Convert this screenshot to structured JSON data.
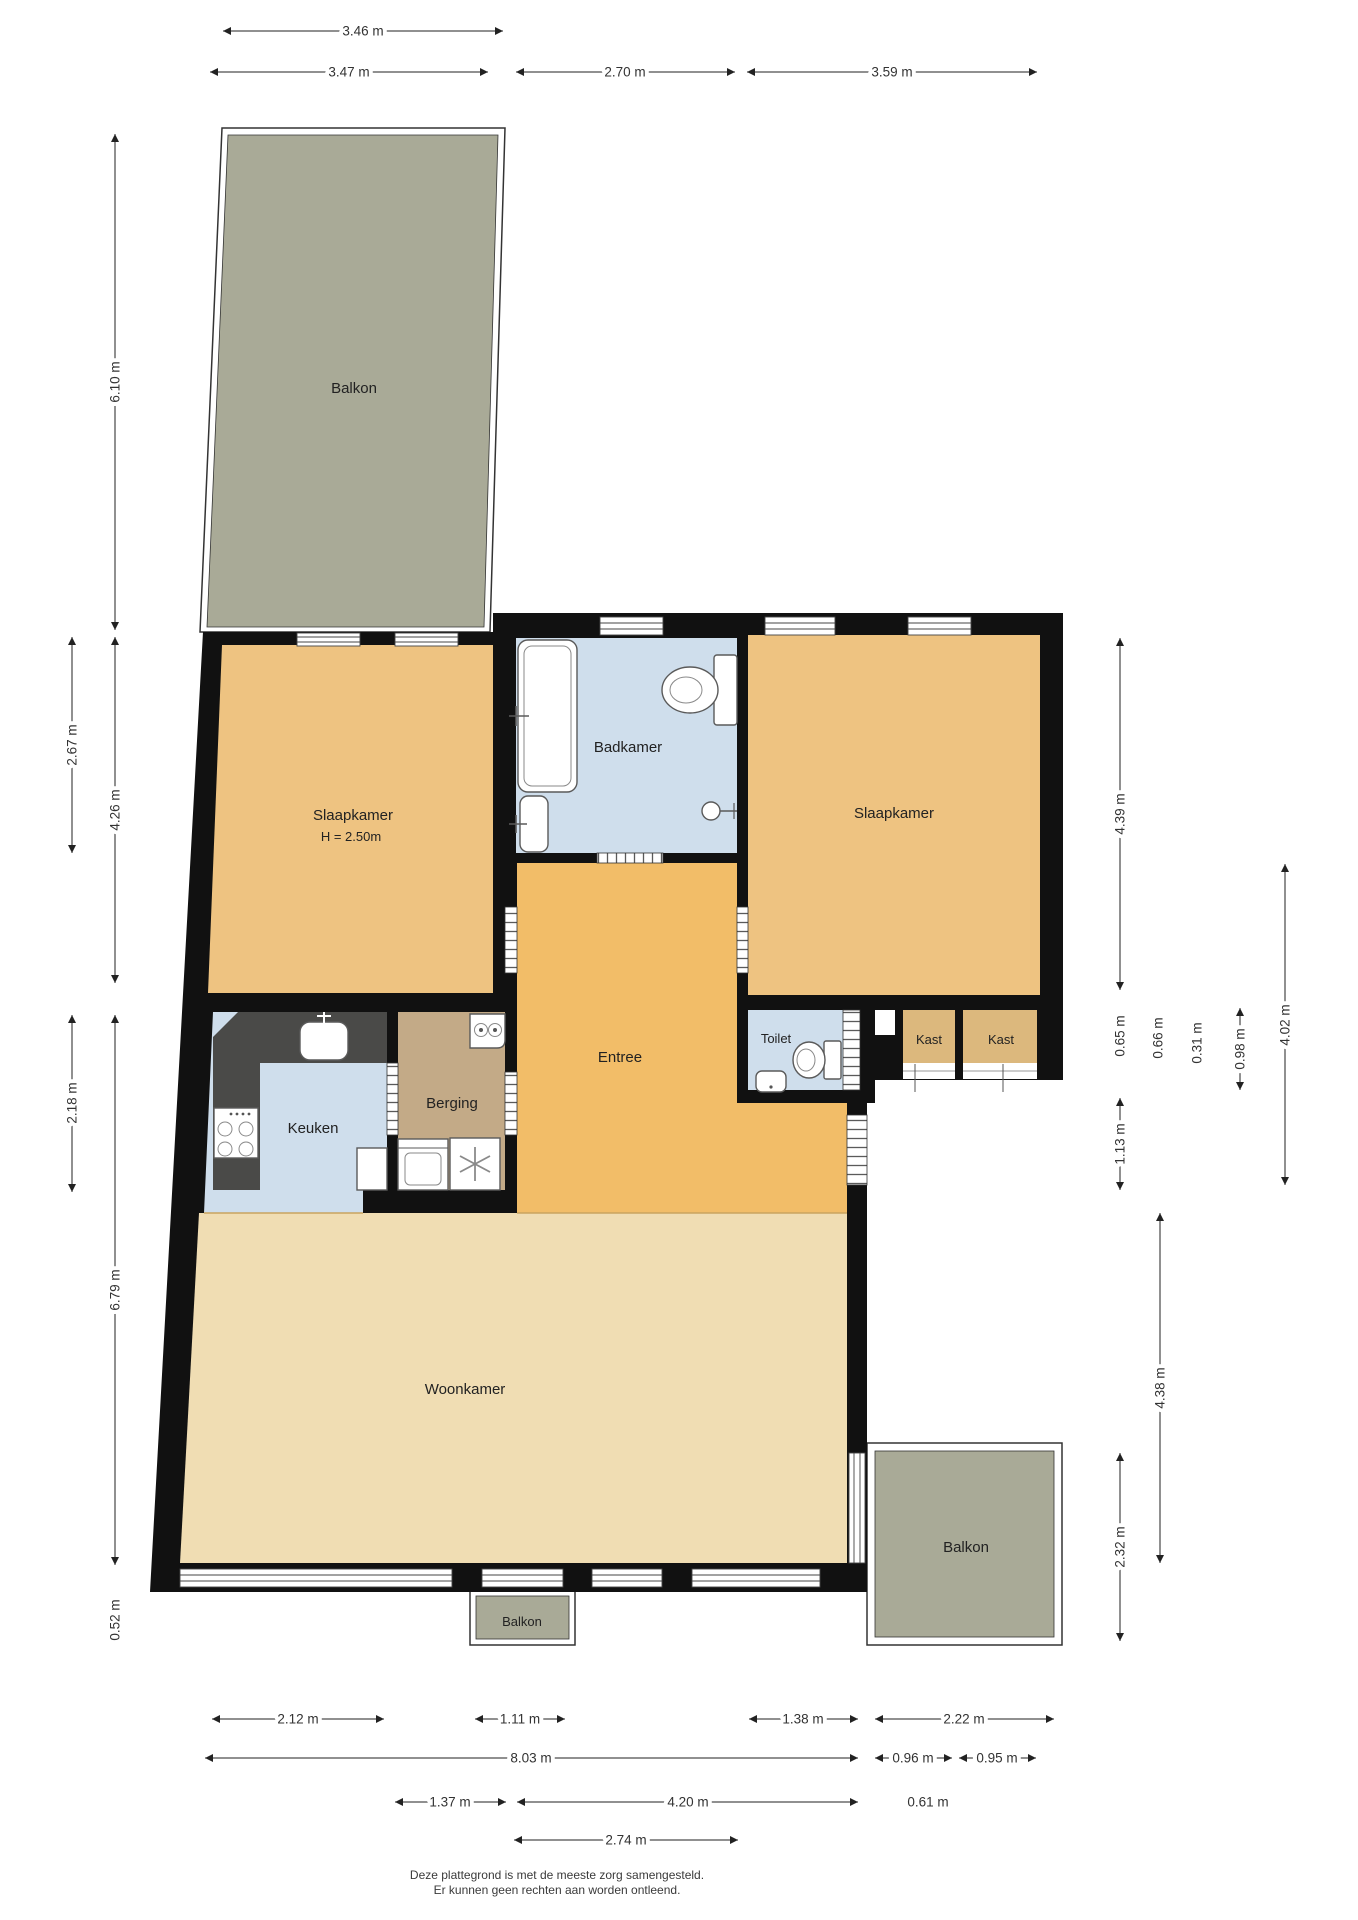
{
  "rooms": {
    "balkon_top": "Balkon",
    "slaapkamer_left": "Slaapkamer",
    "slaapkamer_left_height": "H = 2.50m",
    "badkamer": "Badkamer",
    "slaapkamer_right": "Slaapkamer",
    "entree": "Entree",
    "toilet": "Toilet",
    "kast_left": "Kast",
    "kast_right": "Kast",
    "keuken": "Keuken",
    "berging": "Berging",
    "woonkamer": "Woonkamer",
    "balkon_right": "Balkon",
    "balkon_bottom": "Balkon"
  },
  "dimensions": {
    "top": [
      "3.46 m",
      "3.47 m",
      "2.70 m",
      "3.59 m"
    ],
    "left": [
      "6.10 m",
      "2.67 m",
      "4.26 m",
      "2.18 m",
      "6.79 m",
      "0.52 m"
    ],
    "right": [
      "4.39 m",
      "0.65 m",
      "0.66 m",
      "0.31 m",
      "0.98 m",
      "4.02 m",
      "1.13 m",
      "4.38 m",
      "2.32 m"
    ],
    "bottom": [
      "2.12 m",
      "1.11 m",
      "1.38 m",
      "2.22 m",
      "8.03 m",
      "0.96 m",
      "0.95 m",
      "1.37 m",
      "4.20 m",
      "0.61 m",
      "2.74 m"
    ]
  },
  "footer": {
    "line1": "Deze plattegrond is met de meeste zorg samengesteld.",
    "line2": "Er kunnen geen rechten aan worden ontleend."
  },
  "colors": {
    "wall": "#111111",
    "bedroom": "#eec381",
    "entrance": "#f2bd68",
    "closet": "#dcb87d",
    "wet_room": "#cfdeec",
    "storage": "#c3aa87",
    "living": "#f0ddb3",
    "balcony": "#a9aa97",
    "counter": "#4a4a48"
  }
}
